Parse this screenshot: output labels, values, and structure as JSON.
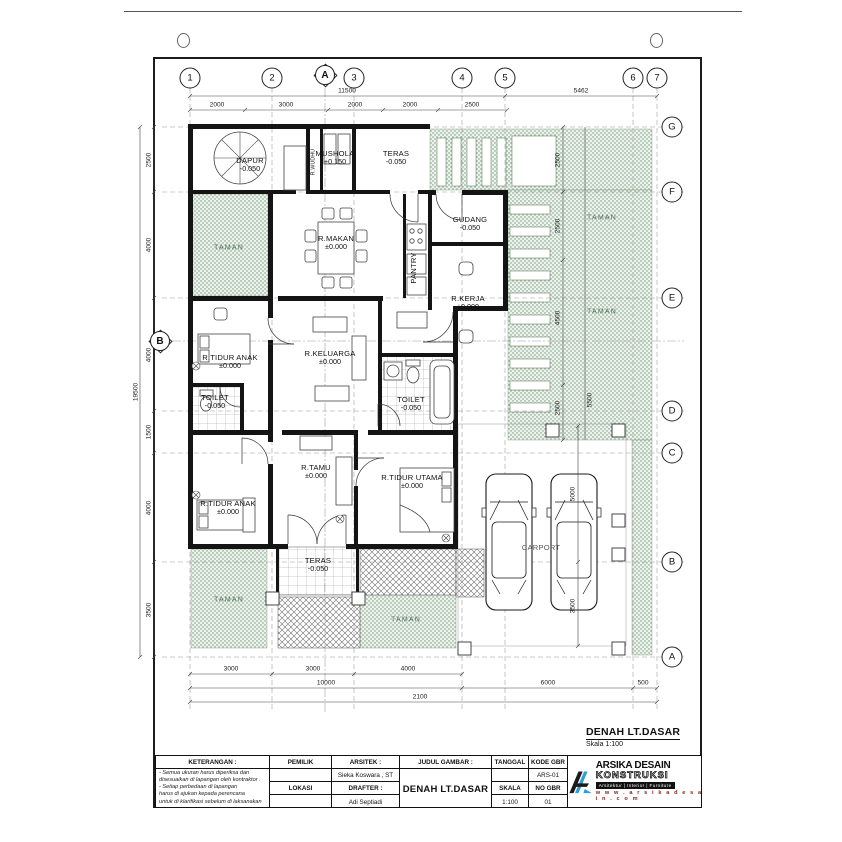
{
  "sheet": {
    "title": "DENAH LT.DASAR",
    "scale": "Skala 1:100"
  },
  "grid": {
    "top": [
      "1",
      "2",
      "3",
      "4",
      "5",
      "6",
      "7"
    ],
    "right": [
      "G",
      "F",
      "E",
      "D",
      "C",
      "B",
      "A"
    ],
    "section_top": "A",
    "section_left": "B"
  },
  "dims": {
    "top_overall": [
      "11500",
      "5462"
    ],
    "top_segments": [
      "2000",
      "3000",
      "2000",
      "2000",
      "2500"
    ],
    "left_overall": "19500",
    "left_segments": [
      "2500",
      "4000",
      "4000",
      "1500",
      "4000",
      "3500"
    ],
    "bottom_row1": [
      "3000",
      "3000",
      "4000"
    ],
    "bottom_row2": [
      "10000",
      "6000",
      "500"
    ],
    "bottom_row3": "2100",
    "inner_right": [
      "2500",
      "2500",
      "4500",
      "2500",
      "5500"
    ],
    "carport": [
      "5000",
      "3500"
    ]
  },
  "rooms": [
    {
      "name": "DAPUR",
      "level": "-0.050"
    },
    {
      "name": "MUSHOLA",
      "level": "+0.150"
    },
    {
      "name": "R.WUDHU",
      "level": ""
    },
    {
      "name": "TERAS",
      "level": "-0.050"
    },
    {
      "name": "GUDANG",
      "level": "-0.050"
    },
    {
      "name": "PANTRY",
      "level": ""
    },
    {
      "name": "R.MAKAN",
      "level": "±0.000"
    },
    {
      "name": "R.KERJA",
      "level": "±0.000"
    },
    {
      "name": "TAMAN",
      "level": ""
    },
    {
      "name": "R.TIDUR ANAK",
      "level": "±0.000"
    },
    {
      "name": "R.KELUARGA",
      "level": "±0.000"
    },
    {
      "name": "TOILET",
      "level": "-0.050"
    },
    {
      "name": "TOILET",
      "level": "-0.050"
    },
    {
      "name": "R.TAMU",
      "level": "±0.000"
    },
    {
      "name": "R.TIDUR ANAK",
      "level": "±0.000"
    },
    {
      "name": "R.TIDUR UTAMA",
      "level": "±0.000"
    },
    {
      "name": "TERAS",
      "level": "-0.050"
    },
    {
      "name": "TAMAN",
      "level": ""
    },
    {
      "name": "TAMAN",
      "level": ""
    },
    {
      "name": "TAMAN",
      "level": ""
    },
    {
      "name": "TAMAN",
      "level": ""
    },
    {
      "name": "CARPORT",
      "level": ""
    }
  ],
  "title_block": {
    "keterangan_label": "KETERANGAN :",
    "notes": [
      "- Semua ukuran harus diperiksa dan",
      "  disesuaikan di lapangan oleh kontraktor .",
      "- Setiap perbedaan di lapangan",
      "  harus di ajukan kepada perencana",
      "  untuk di klarifikasi sebelum di laksanakan"
    ],
    "pemilik_label": "PEMILIK",
    "lokasi_label": "LOKASI",
    "arsitek_label": "ARSITEK :",
    "arsitek_name": "Sieka Koswara , ST",
    "drafter_label": "DRAFTER :",
    "drafter_name": "Adi Septiadi",
    "judul_label": "JUDUL GAMBAR :",
    "judul_value": "DENAH LT.DASAR",
    "tanggal_label": "TANGGAL",
    "skala_label": "SKALA",
    "skala_value": "1:100",
    "kode_label": "KODE GBR",
    "kode_value": "ARS-01",
    "no_label": "NO GBR",
    "no_value": "01"
  },
  "logo": {
    "name_top": "ARSIKA DESAIN",
    "name_bottom": "KONSTRUKSI",
    "tagline": "Arsitektur | Interior | Furniture",
    "website": "w w w . a r s i k a d e s a i n . c o m"
  },
  "colors": {
    "garden_green": "#6e9878",
    "logo_blue": "#2d9fd4",
    "ink": "#111111"
  }
}
